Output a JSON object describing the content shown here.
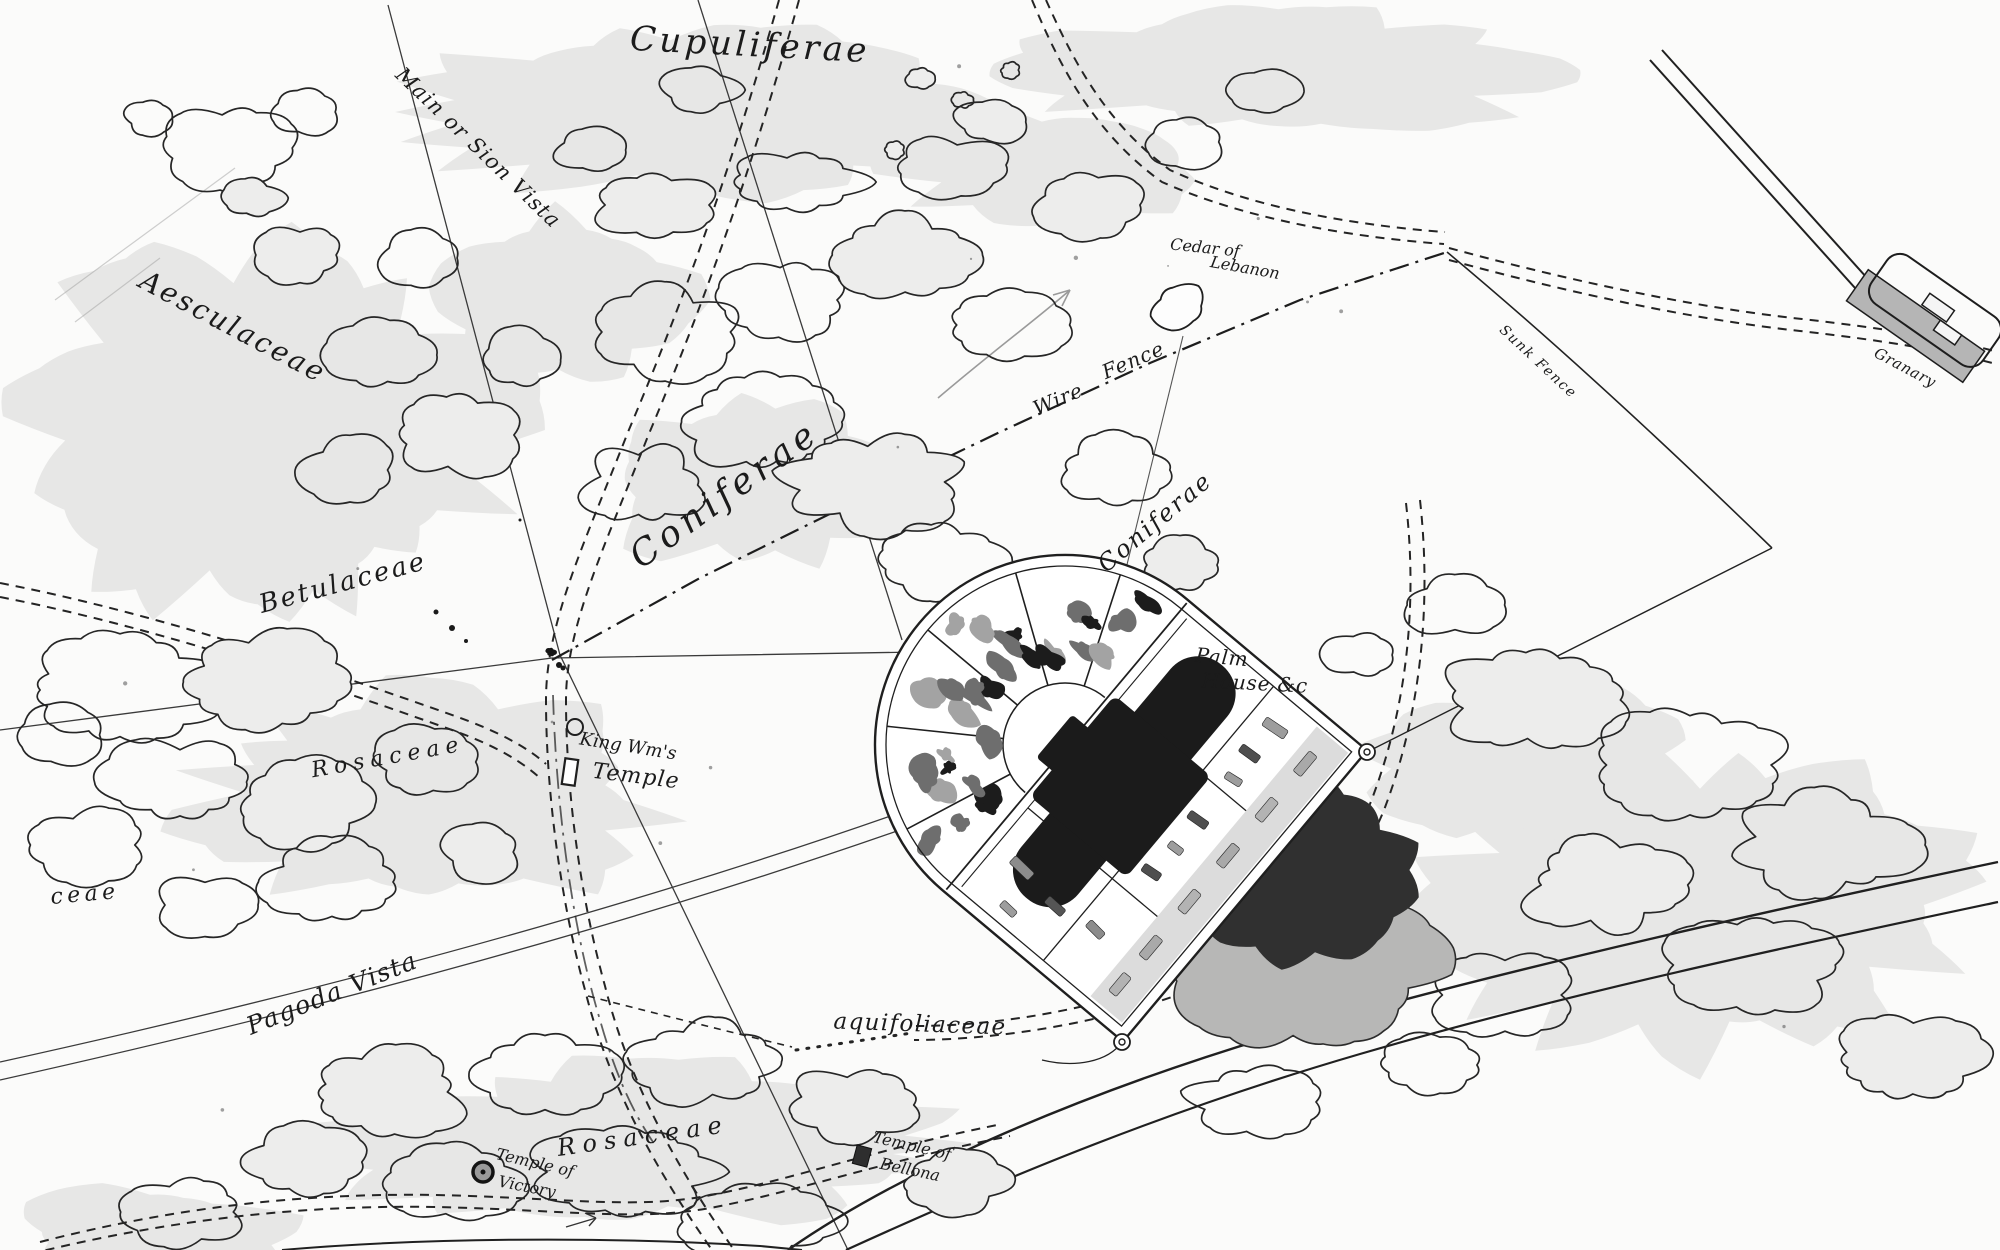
{
  "map": {
    "colors": {
      "paper": "#fbfbfa",
      "ink": "#1f1f1f",
      "wash": "#e7e7e6",
      "pond_dark": "#303030",
      "pond_light": "#b7b7b6",
      "building_dark": "#1b1b1b",
      "terrace_gray": "#dcdcdc"
    },
    "labels": [
      {
        "id": "cupuliferae",
        "text": "Cupuliferae",
        "x": 750,
        "y": 45,
        "rot": 3,
        "size": 34,
        "ls": 0.1
      },
      {
        "id": "main-sion-vista",
        "text": "Main or Sion Vista",
        "x": 478,
        "y": 148,
        "rot": 44,
        "size": 21,
        "ls": 0.06
      },
      {
        "id": "aesculaceae",
        "text": "Aesculaceae",
        "x": 233,
        "y": 327,
        "rot": 28,
        "size": 28,
        "ls": 0.1
      },
      {
        "id": "betulaceae",
        "text": "Betulaceae",
        "x": 343,
        "y": 583,
        "rot": -15,
        "size": 26,
        "ls": 0.1
      },
      {
        "id": "coniferae-main",
        "text": "Coniferae",
        "x": 725,
        "y": 495,
        "rot": -36,
        "size": 36,
        "ls": 0.14
      },
      {
        "id": "coniferae-right",
        "text": "Coniferae",
        "x": 1155,
        "y": 522,
        "rot": -40,
        "size": 24,
        "ls": 0.1
      },
      {
        "id": "wire",
        "text": "Wire",
        "x": 1058,
        "y": 399,
        "rot": -23,
        "size": 20,
        "ls": 0.05
      },
      {
        "id": "fence",
        "text": "Fence",
        "x": 1133,
        "y": 360,
        "rot": -23,
        "size": 20,
        "ls": 0.05
      },
      {
        "id": "cedar-line1",
        "text": "Cedar of",
        "x": 1205,
        "y": 248,
        "rot": 6,
        "size": 16,
        "ls": 0
      },
      {
        "id": "cedar-line2",
        "text": "Lebanon",
        "x": 1245,
        "y": 268,
        "rot": 10,
        "size": 16,
        "ls": 0
      },
      {
        "id": "sunk-fence",
        "text": "Sunk Fence",
        "x": 1538,
        "y": 362,
        "rot": 43,
        "size": 14,
        "ls": 0.12
      },
      {
        "id": "granary",
        "text": "Granary",
        "x": 1905,
        "y": 368,
        "rot": 28,
        "size": 15,
        "ls": 0.05
      },
      {
        "id": "palm-line1",
        "text": "Palm",
        "x": 1222,
        "y": 657,
        "rot": 5,
        "size": 20,
        "ls": 0.04
      },
      {
        "id": "palm-line2",
        "text": "House &c",
        "x": 1255,
        "y": 683,
        "rot": 3,
        "size": 20,
        "ls": 0.04
      },
      {
        "id": "king-line1",
        "text": "King Wm's",
        "x": 628,
        "y": 747,
        "rot": 9,
        "size": 18,
        "ls": 0
      },
      {
        "id": "king-line2",
        "text": "Temple",
        "x": 636,
        "y": 777,
        "rot": 7,
        "size": 22,
        "ls": 0.05
      },
      {
        "id": "rosaceae-mid",
        "text": "Rosaceae",
        "x": 388,
        "y": 758,
        "rot": -10,
        "size": 22,
        "ls": 0.28
      },
      {
        "id": "pagoda-vista",
        "text": "Pagoda Vista",
        "x": 332,
        "y": 993,
        "rot": -22,
        "size": 25,
        "ls": 0.06
      },
      {
        "id": "aquifoliaceae",
        "text": "aquifoliaceae",
        "x": 920,
        "y": 1025,
        "rot": 2,
        "size": 23,
        "ls": 0.06
      },
      {
        "id": "rosaceae-bottom",
        "text": "Rosaceae",
        "x": 643,
        "y": 1136,
        "rot": -8,
        "size": 24,
        "ls": 0.3
      },
      {
        "id": "victory-line1",
        "text": "Temple of",
        "x": 535,
        "y": 1163,
        "rot": 13,
        "size": 16,
        "ls": 0
      },
      {
        "id": "victory-line2",
        "text": "Victory",
        "x": 527,
        "y": 1187,
        "rot": 11,
        "size": 16,
        "ls": 0
      },
      {
        "id": "bellona-line1",
        "text": "Temple of",
        "x": 912,
        "y": 1146,
        "rot": 13,
        "size": 16,
        "ls": 0
      },
      {
        "id": "bellona-line2",
        "text": "Bellona",
        "x": 910,
        "y": 1170,
        "rot": 12,
        "size": 16,
        "ls": 0
      },
      {
        "id": "ceae-left",
        "text": "ceae",
        "x": 85,
        "y": 895,
        "rot": -5,
        "size": 22,
        "ls": 0.2
      }
    ],
    "symbols": [
      {
        "id": "cedar-of-lebanon-tree",
        "kind": "tree",
        "x": 1178,
        "y": 306,
        "rot": 0
      },
      {
        "id": "king-wms-temple-marker",
        "kind": "rect",
        "x": 570,
        "y": 772,
        "rot": 8
      },
      {
        "id": "temple-of-victory-marker",
        "kind": "ringed-dot",
        "x": 483,
        "y": 1172,
        "rot": 0
      },
      {
        "id": "temple-of-bellona-marker",
        "kind": "square",
        "x": 862,
        "y": 1156,
        "rot": 15
      },
      {
        "id": "rosaceae-circle",
        "kind": "circle",
        "x": 575,
        "y": 727,
        "rot": 0
      },
      {
        "id": "fence-gate-ink",
        "kind": "ink",
        "x": 551,
        "y": 652,
        "rot": 0
      },
      {
        "id": "gate-pier-east",
        "kind": "ring",
        "x": 1367,
        "y": 752,
        "rot": 0
      },
      {
        "id": "gate-pier-south",
        "kind": "ring",
        "x": 1122,
        "y": 1042,
        "rot": 0
      }
    ]
  }
}
